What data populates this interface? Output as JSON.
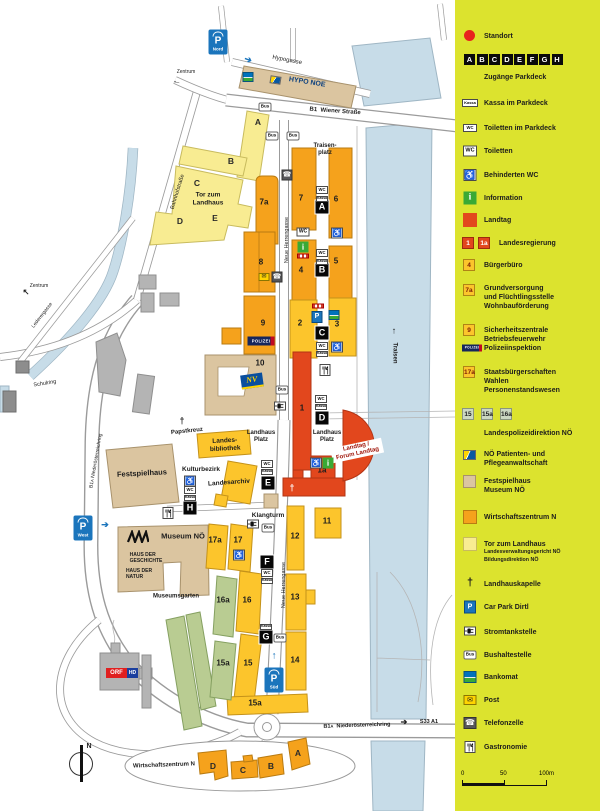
{
  "colors": {
    "legend_bg": "#dce32e",
    "landtag_red": "#e2471d",
    "orange": "#f5a21c",
    "golden_yellow": "#fcc52c",
    "pale_yellow": "#f8ec92",
    "beige": "#dbc5a0",
    "green": "#b9cc92",
    "river_blue": "#c7dce8",
    "info_green": "#3aa935",
    "parking_blue": "#1b75bc"
  },
  "map": {
    "bus": "Bus",
    "wc": "WC",
    "kassa": "Kassa",
    "streets": {
      "hypogasse": "Hypogasse",
      "b1": "B1",
      "wiener": "Wiener Straße",
      "bahnhofstrasse": "Bahnhofstraße",
      "neue_herrengasse": "Neue Herrengasse",
      "b1a": "B1a",
      "niederoesterreichring": "Niederösterreichring",
      "s33_a1": "S33   A1",
      "schulring": "Schulring",
      "lederergasse": "Lederergasse",
      "traisen": "Traisen"
    },
    "places": {
      "zentrum": "Zentrum",
      "traisenplatz": "Traisen-\nplatz",
      "tor_zum_landhaus": "Tor zum\nLandhaus",
      "papstkreuz": "Papstkreuz",
      "landesbibliothek": "Landes-\nbibliothek",
      "landhaus_platz": "Landhaus\nPlatz",
      "kulturbezirk": "Kulturbezirk",
      "landesarchiv": "Landesarchiv",
      "festspielhaus": "Festspielhaus",
      "landtag_forum": "Landtag /\nForum Landtag",
      "klangturm": "Klangturm",
      "museum_noe": "Museum NÖ",
      "haus_der_geschichte": "HAUS DER\nGESCHICHTE",
      "haus_der_natur": "HAUS DER\nNATUR",
      "museumsgarten": "Museumsgarten",
      "wirtschaftszentrum_n": "Wirtschaftszentrum N",
      "hypo_noe": "HYPO NOE",
      "nv": "NV",
      "polizei": "POLIZEI",
      "orf": "ORF",
      "hd": "HD",
      "north": "N"
    },
    "parking": {
      "nord": "Nord",
      "west": "West",
      "sued": "Süd"
    },
    "entrances": [
      "A",
      "B",
      "C",
      "D",
      "E",
      "F",
      "G",
      "H"
    ],
    "tor_letters": [
      "A",
      "B",
      "C",
      "D",
      "E"
    ],
    "wz_letters": [
      "A",
      "B",
      "C",
      "D"
    ],
    "num": {
      "1": "1",
      "1a": "1a",
      "2": "2",
      "3": "3",
      "4": "4",
      "5": "5",
      "6": "6",
      "7": "7",
      "7a": "7a",
      "8": "8",
      "9": "9",
      "10": "10",
      "11": "11",
      "12": "12",
      "13": "13",
      "14": "14",
      "15": "15",
      "15a": "15a",
      "16": "16",
      "16a": "16a",
      "17": "17",
      "17a": "17a"
    }
  },
  "legend": {
    "standort": "Standort",
    "letters": [
      "A",
      "B",
      "C",
      "D",
      "E",
      "F",
      "G",
      "H"
    ],
    "zugaenge": "Zugänge Parkdeck",
    "rows": [
      {
        "label": "Kassa im Parkdeck"
      },
      {
        "label": "Toiletten im Parkdeck"
      },
      {
        "label": "Toiletten"
      },
      {
        "label": "Behinderten WC"
      },
      {
        "label": "Information"
      },
      {
        "label": "Landtag"
      },
      {
        "label": "Landesregierung"
      },
      {
        "label": "Bürgerbüro"
      },
      {
        "label": "Grundversorgung\nund Flüchtlingsstelle\nWohnbauförderung"
      },
      {
        "label": "Sicherheitszentrale\nBetriebsfeuerwehr\nPolizeiinspektion"
      },
      {
        "label": "Staatsbürgerschaften\nWahlen\nPersonenstandswesen"
      },
      {
        "label": "Landespolizeidirektion NÖ"
      },
      {
        "label": "NÖ Patienten- und\nPflegeanwaltschaft"
      },
      {
        "label": "Festspielhaus\nMuseum NÖ"
      },
      {
        "label": "Wirtschaftszentrum N"
      },
      {
        "label": "Tor zum Landhaus",
        "sub": "Landesverwaltungsgericht NÖ\nBildungsdirektion NÖ"
      },
      {
        "label": "Landhauskapelle"
      },
      {
        "label": "Car Park Dirtl"
      },
      {
        "label": "Stromtankstelle"
      },
      {
        "label": "Bushaltestelle"
      },
      {
        "label": "Bankomat"
      },
      {
        "label": "Post"
      },
      {
        "label": "Telefonzelle"
      },
      {
        "label": "Gastronomie"
      }
    ],
    "scale": {
      "t0": "0",
      "t50": "50",
      "t100": "100m"
    }
  }
}
